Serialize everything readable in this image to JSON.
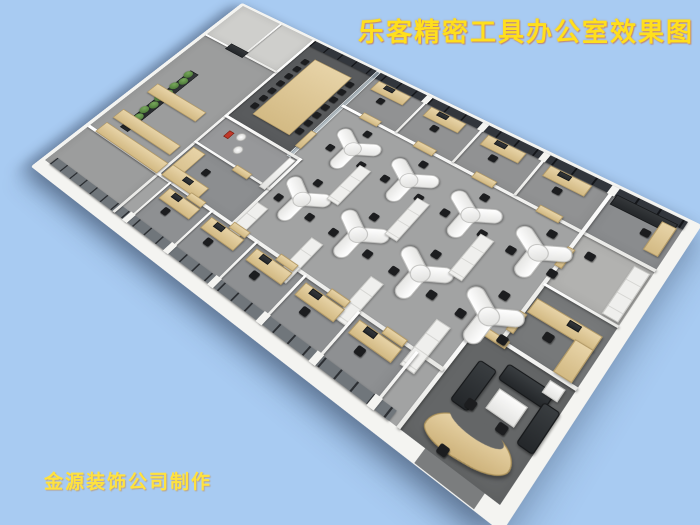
{
  "title": {
    "text": "乐客精密工具办公室效果图"
  },
  "watermark": {
    "text": "金源装饰公司制作"
  },
  "colors": {
    "background": "#a8cbf2",
    "title_text": "#ffdf1d",
    "watermark_text": "#ffe23e",
    "exterior_wall": "#f4f4f1",
    "open_office_floor": "#a2a3a3",
    "conference_floor": "#595b5d",
    "lounge_floor": "#646667",
    "window_glass": "#32363c",
    "wood_furniture": "#d9c08c",
    "white_workstation": "#f5f5f3",
    "office_chair": "#1c1d1f",
    "sofa": "#2e3133",
    "plants": "#4d7c3a"
  }
}
